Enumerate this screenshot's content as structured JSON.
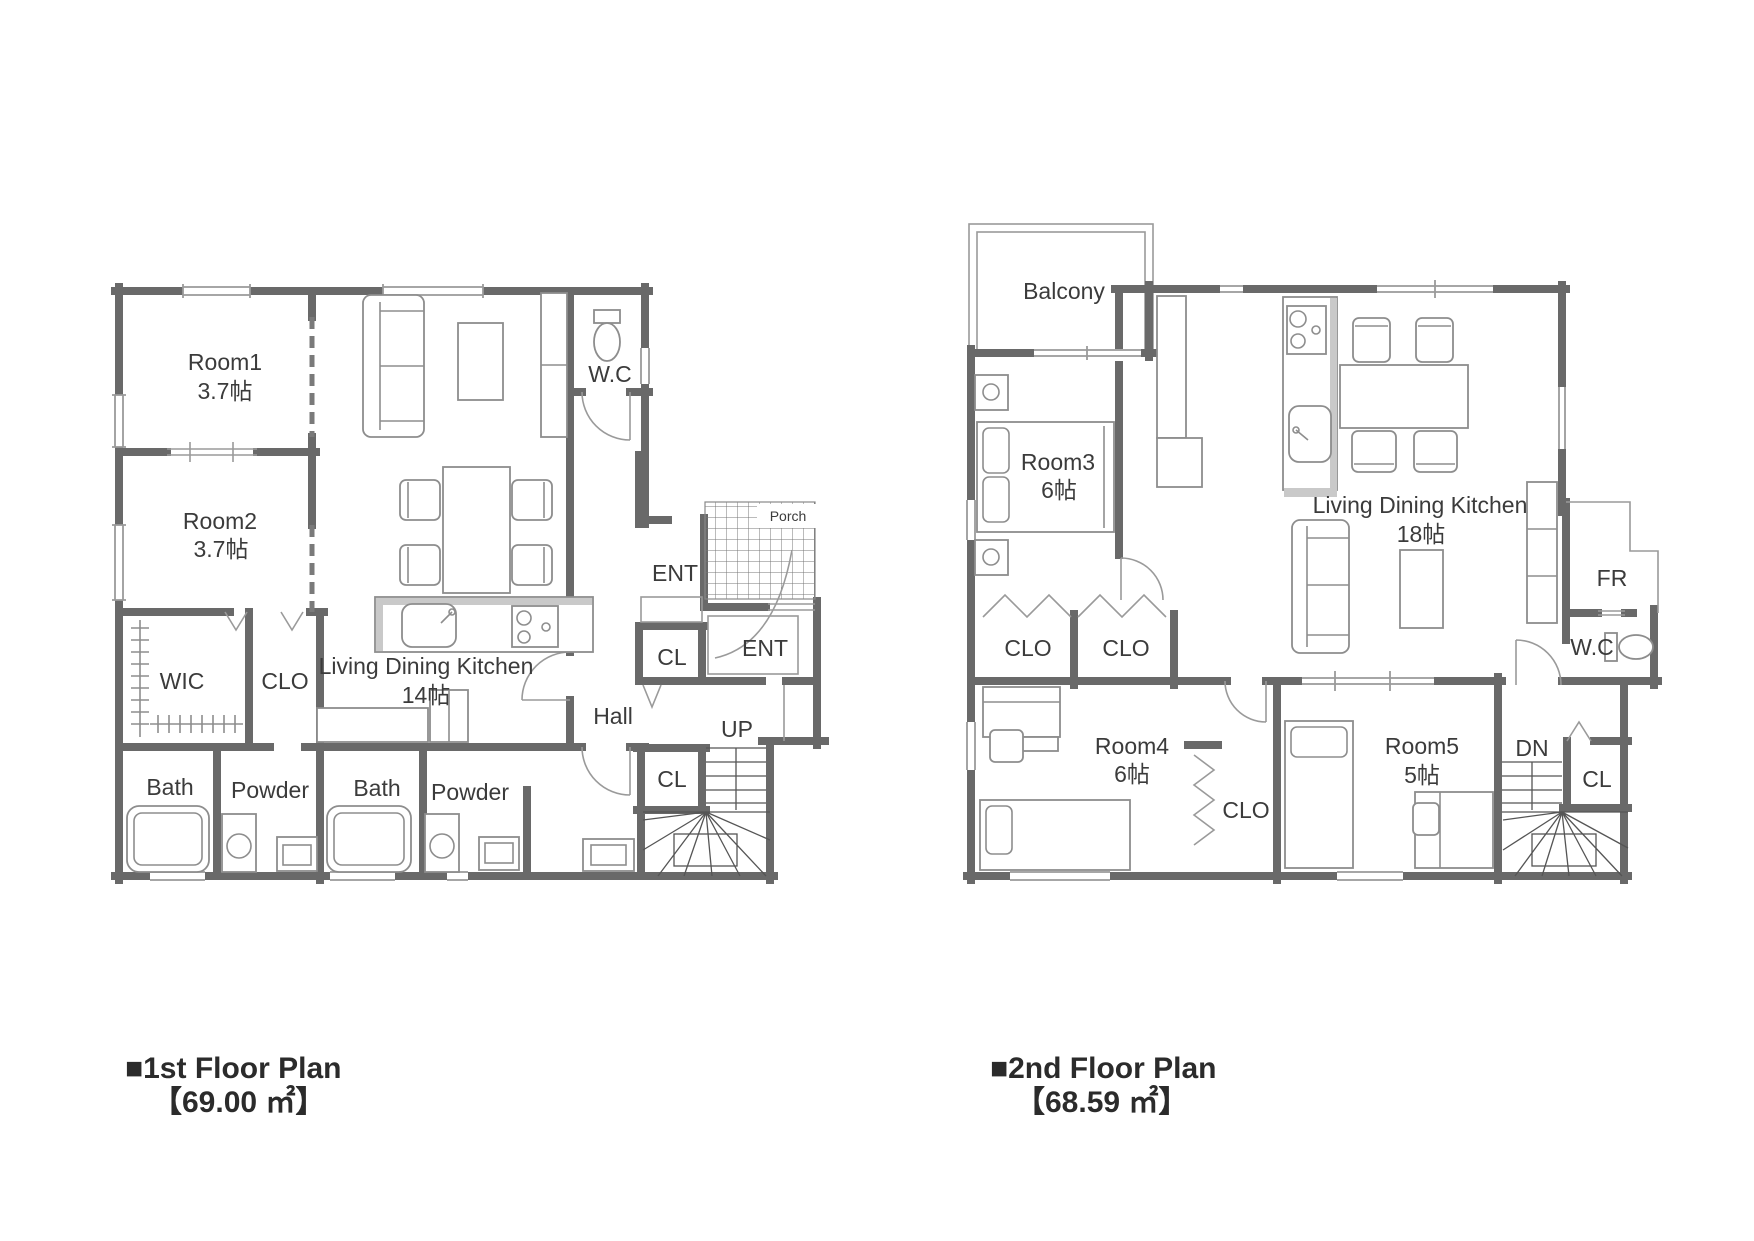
{
  "floor1": {
    "caption": {
      "title": "■1st Floor Plan",
      "area": "【69.00 ㎡】"
    },
    "rooms": {
      "room1": "Room1",
      "room1_size": "3.7帖",
      "room2": "Room2",
      "room2_size": "3.7帖",
      "wc": "W.C",
      "ent_upper": "ENT",
      "porch": "Porch",
      "ent_lower": "ENT",
      "cl_upper": "CL",
      "hall": "Hall",
      "up": "UP",
      "cl_lower": "CL",
      "wic": "WIC",
      "clo": "CLO",
      "ldk": "Living Dining Kitchen",
      "ldk_size": "14帖",
      "bath_left": "Bath",
      "powder_left": "Powder",
      "bath_right": "Bath",
      "powder_right": "Powder"
    }
  },
  "floor2": {
    "caption": {
      "title": "■2nd Floor Plan",
      "area": "【68.59 ㎡】"
    },
    "rooms": {
      "balcony": "Balcony",
      "room3": "Room3",
      "room3_size": "6帖",
      "ldk": "Living Dining Kitchen",
      "ldk_size": "18帖",
      "fr": "FR",
      "wc": "W.C",
      "clo_left": "CLO",
      "clo_right": "CLO",
      "room4": "Room4",
      "room4_size": "6帖",
      "clo_mid": "CLO",
      "room5": "Room5",
      "room5_size": "5帖",
      "dn": "DN",
      "cl": "CL"
    }
  }
}
